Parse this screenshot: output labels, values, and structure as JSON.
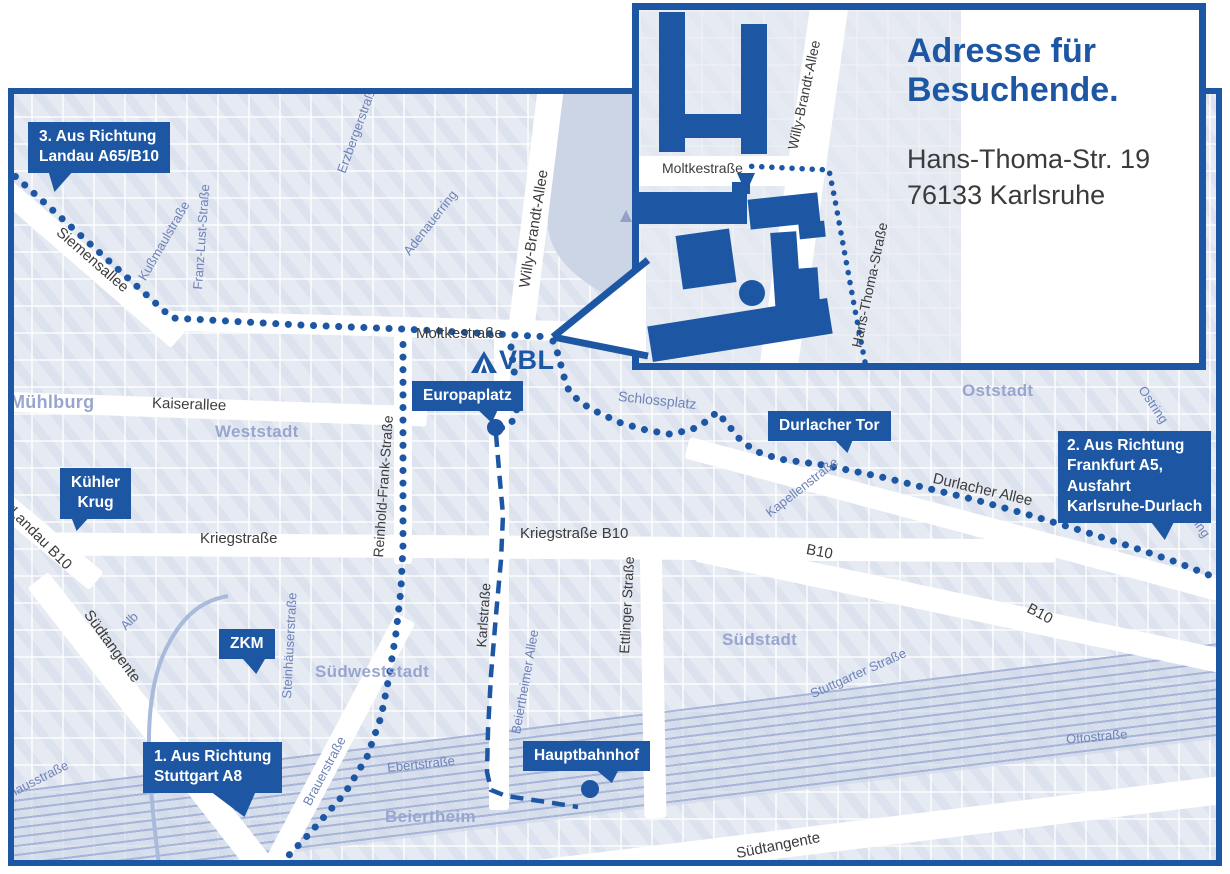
{
  "colors": {
    "accent": "#1d57a4",
    "map_background": "#e6eaf2",
    "park": "#ccd5e6",
    "dark_street_text": "#3c3c3c",
    "minor_street_text": "#6d82b8",
    "district_text": "#98a6cf"
  },
  "logo": {
    "text": "VBL"
  },
  "inset": {
    "title": "Adresse für\nBesuchende.",
    "address": "Hans-Thoma-Str. 19\n76133 Karlsruhe",
    "street_moltke": "Moltkestraße",
    "street_willy": "Willy-Brandt-Allee",
    "street_hans_thoma": "Hans-Thoma-Straße"
  },
  "markers": {
    "landau": "3. Aus Richtung\nLandau A65/B10",
    "frankfurt": "2. Aus Richtung\nFrankfurt A5,\nAusfahrt\nKarlsruhe-Durlach",
    "stuttgart": "1. Aus Richtung\nStuttgart A8",
    "kuehler_krug": "Kühler\nKrug",
    "zkm": "ZKM",
    "europaplatz": "Europaplatz",
    "durlacher_tor": "Durlacher Tor",
    "hauptbahnhof": "Hauptbahnhof"
  },
  "streets": {
    "siemensallee": "Siemensallee",
    "moltkestrasse": "Moltkestraße",
    "kaiserallee": "Kaiserallee",
    "willy_brandt": "Willy-Brandt-Allee",
    "reinhold_frank": "Reinhold-Frank-Straße",
    "kriegstrasse": "Kriegstraße",
    "kriegstrasse_b10": "Kriegstraße B10",
    "karlstrasse": "Karlstraße",
    "ettlinger": "Ettlinger Straße",
    "durlacher_allee": "Durlacher Allee",
    "b10_a": "B10",
    "b10_b": "B10",
    "suedtangente_left": "Südtangente",
    "suedtangente_bottom": "Südtangente",
    "landau_arrow": "◀",
    "landau_b10": "Landau B10",
    "kussmaul": "Kußmaulstraße",
    "franz_lust": "Franz-Lust-Straße",
    "erzberger": "Erzbergerstraße",
    "adenauerring": "Adenauerring",
    "schlossplatz": "Schlossplatz",
    "kapellenstrasse": "Kapellenstraße",
    "ostring_a": "Ostring",
    "ostring_b": "Ostring",
    "alb": "Alb",
    "steinhaeuser": "Steinhäuserstraße",
    "brauerstrasse": "Brauerstraße",
    "ebertstrasse": "Ebertstraße",
    "beiertheimer_allee": "Beiertheimer Allee",
    "stuttgarter": "Stuttgarter Straße",
    "ottostrasse": "Ottostraße",
    "pulverhaus": "Pulverhausstraße"
  },
  "districts": {
    "muehlburg": "Mühlburg",
    "weststadt": "Weststadt",
    "oststadt": "Oststadt",
    "suedstadt": "Südstadt",
    "suedweststadt": "Südweststadt",
    "beiertheim": "Beiertheim"
  }
}
